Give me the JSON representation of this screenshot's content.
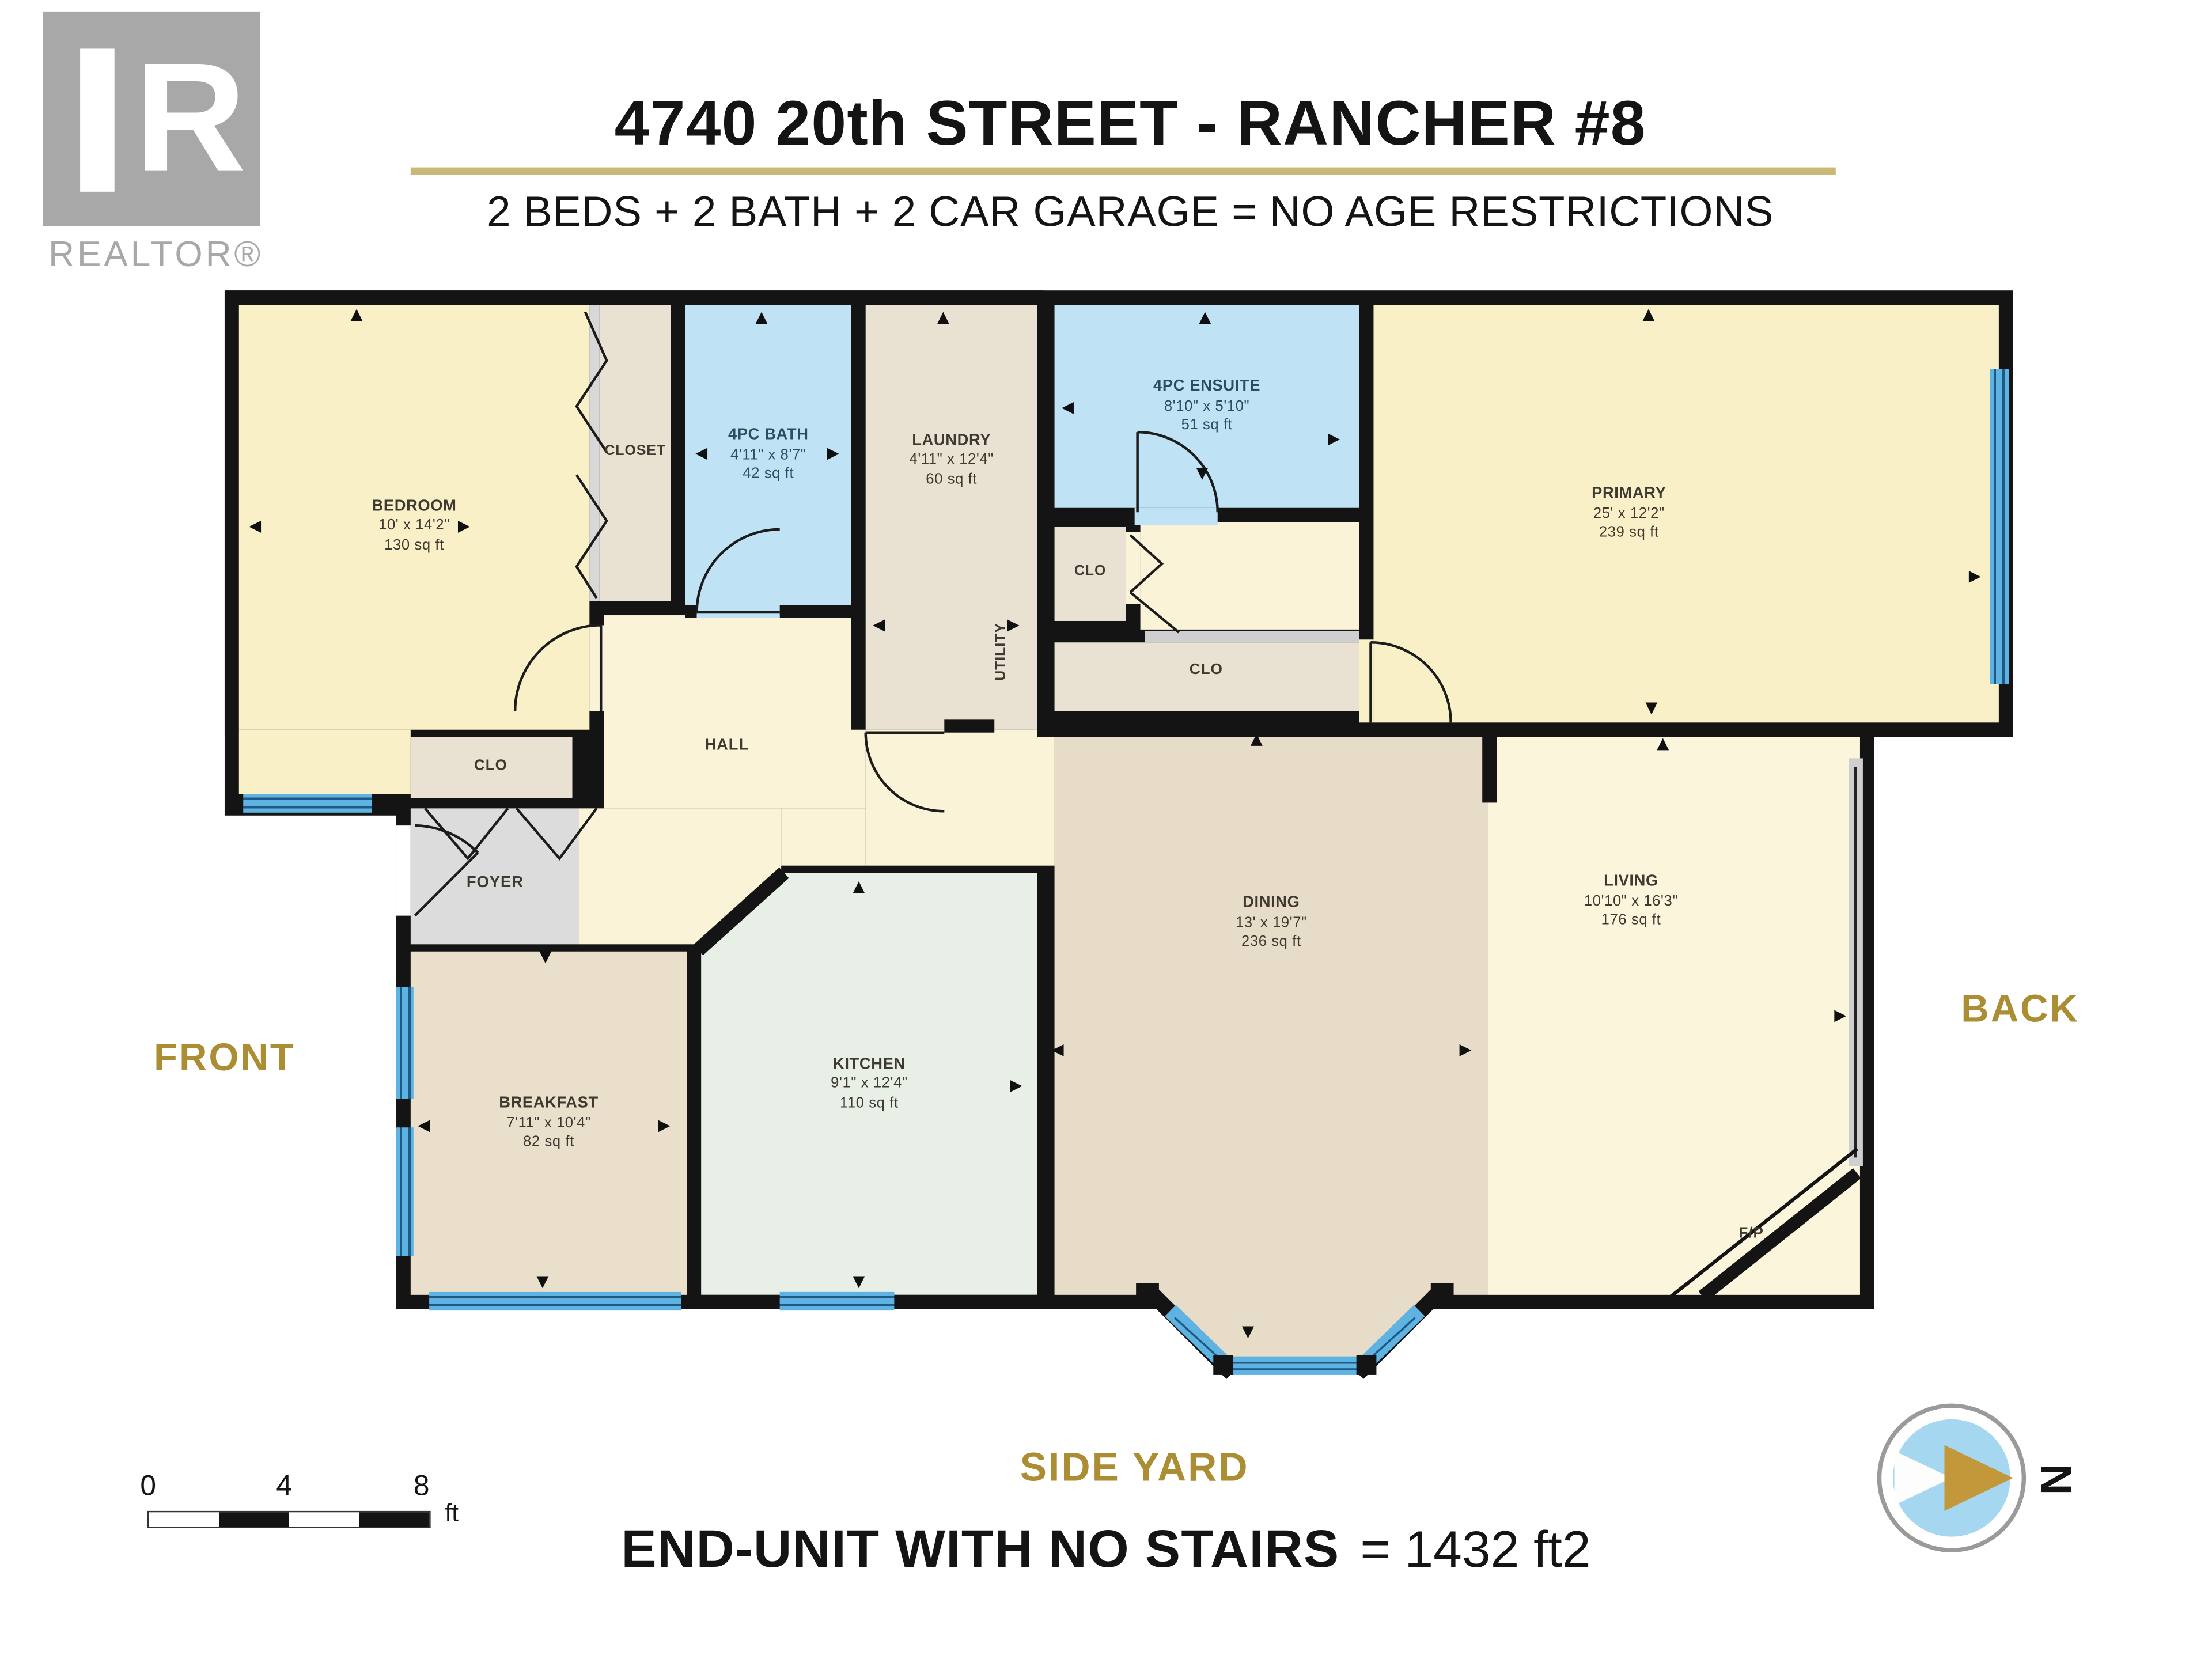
{
  "logo": {
    "letter": "R",
    "realtor_text": "REALTOR®"
  },
  "header": {
    "title": "4740 20th STREET - RANCHER #8",
    "subtitle": "2 BEDS + 2 BATH + 2 CAR GARAGE = NO AGE RESTRICTIONS"
  },
  "site_labels": {
    "front": "FRONT",
    "back": "BACK",
    "side_yard": "SIDE YARD"
  },
  "footer": {
    "bold": "END-UNIT WITH NO STAIRS",
    "rest": "= 1432 ft2"
  },
  "scale_bar": {
    "ticks": [
      "0",
      "4",
      "8"
    ],
    "unit": "ft"
  },
  "compass": {
    "north_label": "N"
  },
  "glyphs": {
    "up": "▲",
    "down": "▼",
    "left": "◀",
    "right": "▶"
  },
  "colors": {
    "gold_accent": "#ab8d33",
    "title_rule": "#c9b876",
    "wall": "#141414",
    "window_blue": "#5fb3e2",
    "bath_blue": "#bfe3f4",
    "cream_room": "#faf0c8",
    "tan_room": "#e6dcc8",
    "mint_room": "#e7efe7",
    "foyer_gray": "#dcdcdc",
    "compass_gold": "#c3983a",
    "logo_gray": "#a8a8a8"
  },
  "rooms": {
    "bedroom": {
      "name": "BEDROOM",
      "dims": "10' x 14'2\"",
      "area": "130 sq ft"
    },
    "closet": {
      "name": "CLOSET"
    },
    "bath": {
      "name": "4PC BATH",
      "dims": "4'11\" x 8'7\"",
      "area": "42 sq ft"
    },
    "laundry": {
      "name": "LAUNDRY",
      "dims": "4'11\" x 12'4\"",
      "area": "60 sq ft"
    },
    "utility": {
      "name": "UTILITY"
    },
    "ensuite": {
      "name": "4PC ENSUITE",
      "dims": "8'10\" x 5'10\"",
      "area": "51 sq ft"
    },
    "clo_small": {
      "name": "CLO"
    },
    "clo_wide": {
      "name": "CLO"
    },
    "clo_foyer": {
      "name": "CLO"
    },
    "primary": {
      "name": "PRIMARY",
      "dims": "25' x 12'2\"",
      "area": "239 sq ft"
    },
    "hall": {
      "name": "HALL"
    },
    "foyer": {
      "name": "FOYER"
    },
    "breakfast": {
      "name": "BREAKFAST",
      "dims": "7'11\" x 10'4\"",
      "area": "82 sq ft"
    },
    "kitchen": {
      "name": "KITCHEN",
      "dims": "9'1\" x 12'4\"",
      "area": "110 sq ft"
    },
    "dining": {
      "name": "DINING",
      "dims": "13' x 19'7\"",
      "area": "236 sq ft"
    },
    "living": {
      "name": "LIVING",
      "dims": "10'10\" x 16'3\"",
      "area": "176 sq ft"
    },
    "fireplace": {
      "name": "F/P"
    }
  }
}
